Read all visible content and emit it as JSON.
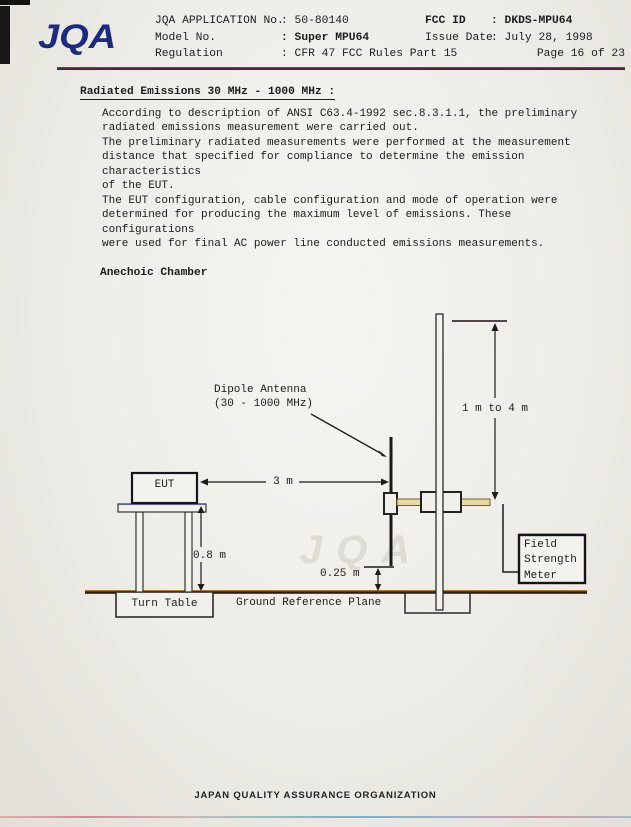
{
  "header": {
    "logo_text": "JQA",
    "left": [
      {
        "label": "JQA APPLICATION No.",
        "value": ": 50-80140"
      },
      {
        "label": "Model No.",
        "value": ": Super MPU64"
      },
      {
        "label": "Regulation",
        "value": ": CFR 47 FCC Rules Part 15"
      }
    ],
    "right": [
      {
        "label": "FCC ID",
        "value": ": DKDS-MPU64"
      },
      {
        "label": "Issue Date",
        "value": ": July 28, 1998"
      },
      {
        "label": "",
        "value": "Page 16 of 23"
      }
    ]
  },
  "section": {
    "title": "Radiated Emissions 30 MHz - 1000 MHz :",
    "paragraphs": [
      "According to description of ANSI C63.4-1992 sec.8.3.1.1, the preliminary\nradiated emissions measurement were carried out.",
      "The preliminary radiated measurements were performed at the measurement\ndistance that specified for compliance to determine the emission characteristics\nof the EUT.",
      "The EUT configuration, cable configuration and mode of operation were\ndetermined for producing the maximum level of emissions. These configurations\nwere used for final AC power line conducted emissions measurements."
    ]
  },
  "diagram": {
    "title": "Anechoic Chamber",
    "labels": {
      "dipole_antenna": "Dipole Antenna\n(30 - 1000 MHz)",
      "antenna_height": "1 m to 4 m",
      "distance": "3 m",
      "table_height": "0.8 m",
      "antenna_bottom_height": "0.25 m",
      "eut": "EUT",
      "turn_table": "Turn Table",
      "ground_plane": "Ground Reference Plane",
      "field_strength_meter": "Field\nStrength\nMeter"
    },
    "watermark": "JQA"
  },
  "footer": {
    "text": "JAPAN QUALITY ASSURANCE ORGANIZATION"
  },
  "colors": {
    "logo_blue": "#1b2b7e",
    "header_rule": "#8c3432",
    "ground_brown": "#2a1e10",
    "ground_fringe": "#b0782a"
  }
}
